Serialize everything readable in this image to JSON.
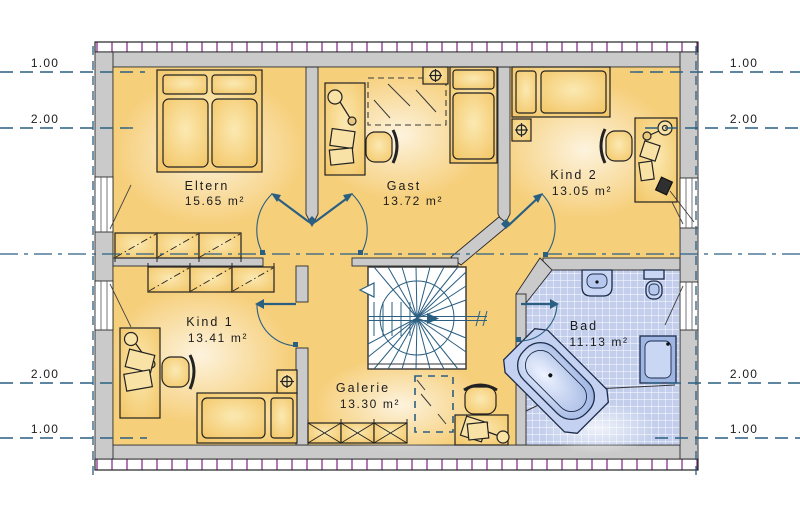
{
  "plan": {
    "rooms": [
      {
        "name": "Eltern",
        "area": "15.65 m²"
      },
      {
        "name": "Gast",
        "area": "13.72 m²"
      },
      {
        "name": "Kind 2",
        "area": "13.05 m²"
      },
      {
        "name": "Kind 1",
        "area": "13.41 m²"
      },
      {
        "name": "Galerie",
        "area": "13.30 m²"
      },
      {
        "name": "Bad",
        "area": "11.13 m²"
      }
    ],
    "dimension_labels": {
      "left": [
        "1.00",
        "2.00",
        "2.00",
        "1.00"
      ],
      "right": [
        "1.00",
        "2.00",
        "2.00",
        "1.00"
      ]
    },
    "colors": {
      "floor": "#f6cf7b",
      "floor_highlight": "#fdf0c6",
      "furniture": "#f2c25e",
      "wall": "#cbcacb",
      "blue_line": "#2a5f82",
      "tile": "#c2ceeb",
      "fixture": "#c9d6f4",
      "hatch_tick": "#8a2f8f",
      "text": "#1c1c1c"
    }
  }
}
